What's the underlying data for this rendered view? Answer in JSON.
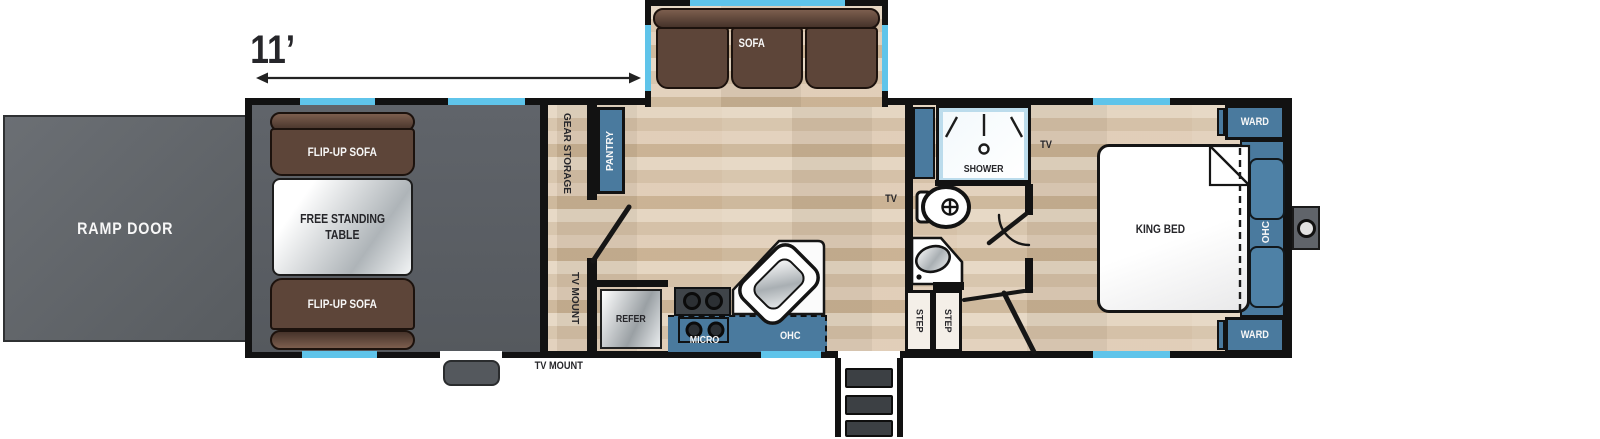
{
  "dimension_label": "11’",
  "exterior": {
    "ramp_door_label": "RAMP DOOR",
    "tv_mount_label": "TV MOUNT"
  },
  "garage": {
    "sofa_top_label": "FLIP-UP SOFA",
    "sofa_bottom_label": "FLIP-UP SOFA",
    "table_label_line1": "FREE STANDING",
    "table_label_line2": "TABLE",
    "gear_storage_label": "GEAR STORAGE",
    "tv_mount_label": "TV MOUNT"
  },
  "living": {
    "sofa_label": "SOFA",
    "pantry_label": "PANTRY",
    "tv_label": "TV"
  },
  "kitchen": {
    "refer_label": "REFER",
    "micro_label": "MICRO",
    "ohc_label": "OHC"
  },
  "bathroom": {
    "shower_label": "SHOWER",
    "step1_label": "STEP",
    "step2_label": "STEP"
  },
  "bedroom": {
    "king_bed_label": "KING BED",
    "ward_top_label": "WARD",
    "ward_bottom_label": "WARD",
    "ohc_label": "OHC",
    "tv_label": "TV"
  },
  "colors": {
    "wall": "#121212",
    "cabinet_blue": "#4a7a9e",
    "window_blue": "#5fc4ea",
    "wood": "#d8c3ab",
    "garage_floor": "#5c6065",
    "sofa_brown": "#5d4539",
    "ramp_gray": "#63676b"
  }
}
